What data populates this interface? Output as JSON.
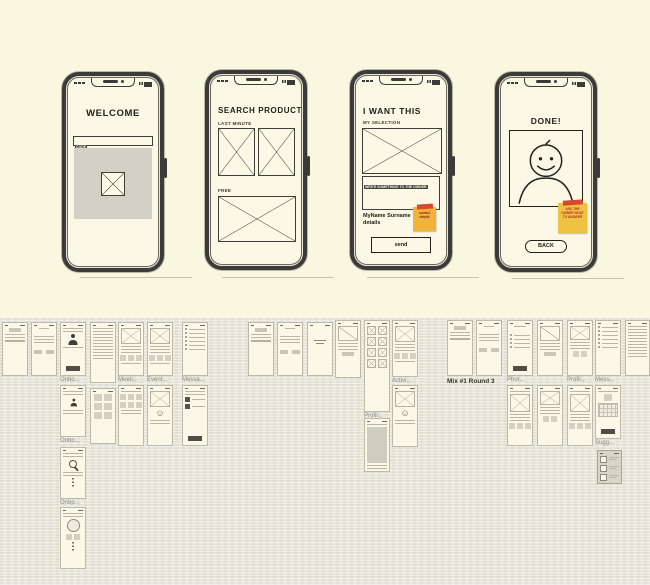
{
  "colors": {
    "background_top": "#faf7e1",
    "background_canvas": "#e9e6da",
    "phone_body": "#3b3b39",
    "sticky_orange": "#f2b33d",
    "sticky_tape_red": "#d6492f",
    "placeholder_gray": "#d3d0c5"
  },
  "icons": {
    "smiley_face": "☺"
  },
  "phones": {
    "welcome": {
      "title": "WELCOME",
      "code_value": "CODE"
    },
    "search": {
      "title": "SEARCH PRODUCT",
      "section_last_minute": "LAST MINUTE",
      "section_free": "FREE"
    },
    "want": {
      "title": "I WANT THIS",
      "subtitle": "MY SELECTION",
      "textarea_placeholder": "WRITE SOMETHING TO THE OWNER",
      "contact_name": "MyName Surname",
      "contact_details_word": "details",
      "sticky_note": "contact details",
      "send_label": "send"
    },
    "done": {
      "title": "DONE!",
      "sticky_note": "ASK THE OWNER WHAT TO ANSWER",
      "back_label": "BACK"
    }
  },
  "canvas": {
    "mix_note": "Mix #1 Round 3",
    "frames": [
      {
        "x": 2,
        "y": 4,
        "w": 26,
        "h": 54,
        "variant": "formx"
      },
      {
        "x": 31,
        "y": 4,
        "w": 26,
        "h": 54,
        "variant": "account"
      },
      {
        "x": 60,
        "y": 4,
        "w": 26,
        "h": 54,
        "variant": "person",
        "label": "Onbo..."
      },
      {
        "x": 90,
        "y": 4,
        "w": 26,
        "h": 61,
        "variant": "list"
      },
      {
        "x": 118,
        "y": 4,
        "w": 26,
        "h": 54,
        "variant": "feedx",
        "label": "Meeti..."
      },
      {
        "x": 147,
        "y": 4,
        "w": 26,
        "h": 54,
        "variant": "feedx",
        "label": "Event..."
      },
      {
        "x": 182,
        "y": 4,
        "w": 26,
        "h": 54,
        "variant": "msglist",
        "label": "Messa..."
      },
      {
        "x": 60,
        "y": 67,
        "w": 26,
        "h": 52,
        "variant": "personsm",
        "label": "Onbo..."
      },
      {
        "x": 90,
        "y": 70,
        "w": 26,
        "h": 56,
        "variant": "grid"
      },
      {
        "x": 118,
        "y": 67,
        "w": 26,
        "h": 61,
        "variant": "icons"
      },
      {
        "x": 147,
        "y": 67,
        "w": 26,
        "h": 61,
        "variant": "smileyx"
      },
      {
        "x": 182,
        "y": 67,
        "w": 26,
        "h": 61,
        "variant": "darklist"
      },
      {
        "x": 60,
        "y": 129,
        "w": 26,
        "h": 52,
        "variant": "search",
        "label": "Onbo..."
      },
      {
        "x": 60,
        "y": 189,
        "w": 26,
        "h": 62,
        "variant": "circle"
      },
      {
        "x": 248,
        "y": 4,
        "w": 26,
        "h": 54,
        "variant": "formx"
      },
      {
        "x": 277,
        "y": 4,
        "w": 26,
        "h": 54,
        "variant": "account"
      },
      {
        "x": 307,
        "y": 4,
        "w": 26,
        "h": 54,
        "variant": "textcenter"
      },
      {
        "x": 335,
        "y": 2,
        "w": 26,
        "h": 58,
        "variant": "chart"
      },
      {
        "x": 364,
        "y": 2,
        "w": 26,
        "h": 92,
        "variant": "gridx",
        "label": "Profil..."
      },
      {
        "x": 364,
        "y": 100,
        "w": 26,
        "h": 54,
        "variant": "photo"
      },
      {
        "x": 392,
        "y": 2,
        "w": 26,
        "h": 57,
        "variant": "feedx",
        "label": "Activi..."
      },
      {
        "x": 392,
        "y": 67,
        "w": 26,
        "h": 62,
        "variant": "smileyx"
      },
      {
        "x": 447,
        "y": 2,
        "w": 26,
        "h": 56,
        "variant": "formx"
      },
      {
        "x": 476,
        "y": 2,
        "w": 26,
        "h": 56,
        "variant": "account"
      },
      {
        "x": 507,
        "y": 2,
        "w": 26,
        "h": 56,
        "variant": "onboarddark",
        "label": "Phot..."
      },
      {
        "x": 507,
        "y": 67,
        "w": 26,
        "h": 61,
        "variant": "photox"
      },
      {
        "x": 537,
        "y": 2,
        "w": 26,
        "h": 56,
        "variant": "chart"
      },
      {
        "x": 537,
        "y": 67,
        "w": 26,
        "h": 61,
        "variant": "xdetail"
      },
      {
        "x": 567,
        "y": 2,
        "w": 26,
        "h": 56,
        "variant": "xdetail",
        "label": "Profil..."
      },
      {
        "x": 567,
        "y": 67,
        "w": 26,
        "h": 61,
        "variant": "photox"
      },
      {
        "x": 595,
        "y": 2,
        "w": 26,
        "h": 56,
        "variant": "msglist",
        "label": "Mess..."
      },
      {
        "x": 595,
        "y": 67,
        "w": 26,
        "h": 54,
        "variant": "keyboard",
        "label": "Sugg..."
      },
      {
        "x": 597,
        "y": 132,
        "w": 25,
        "h": 34,
        "variant": "checklist"
      },
      {
        "x": 625,
        "y": 2,
        "w": 25,
        "h": 56,
        "variant": "list"
      }
    ]
  }
}
